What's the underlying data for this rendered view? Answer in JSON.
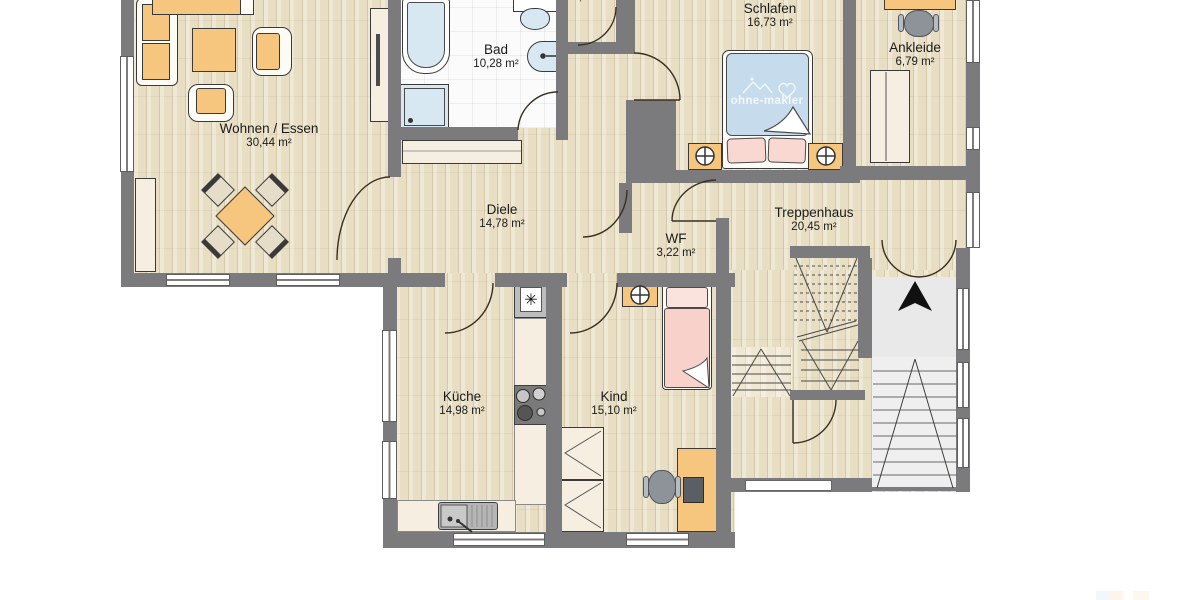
{
  "plan": {
    "rooms": [
      {
        "id": "wohnen-essen",
        "name": "Wohnen / Essen",
        "area": "30,44 m²"
      },
      {
        "id": "bad",
        "name": "Bad",
        "area": "10,28 m²"
      },
      {
        "id": "flur-klein",
        "name": "",
        "area": "1,48 m²"
      },
      {
        "id": "schlafen",
        "name": "Schlafen",
        "area": "16,73 m²"
      },
      {
        "id": "ankleide",
        "name": "Ankleide",
        "area": "6,79 m²"
      },
      {
        "id": "diele",
        "name": "Diele",
        "area": "14,78 m²"
      },
      {
        "id": "treppenhaus",
        "name": "Treppenhaus",
        "area": "20,45 m²"
      },
      {
        "id": "wf",
        "name": "WF",
        "area": "3,22 m²"
      },
      {
        "id": "kueche",
        "name": "Küche",
        "area": "14,98 m²"
      },
      {
        "id": "kind",
        "name": "Kind",
        "area": "15,10 m²"
      }
    ],
    "watermark": {
      "text": "ohne-makler"
    },
    "icons": {
      "freezer": "✳"
    },
    "colors": {
      "wall": "#7b7a7c",
      "wood_floor": "#e8dec3",
      "furniture_accent": "#f6c57e",
      "bed_blanket_blue": "#c6dcec",
      "pillow_pink": "#f8d8d0",
      "bath_fixture_blue": "#d7e8f2",
      "entry_floor_gray": "#e9e9e9",
      "counter_cream": "#f6eee1"
    }
  }
}
